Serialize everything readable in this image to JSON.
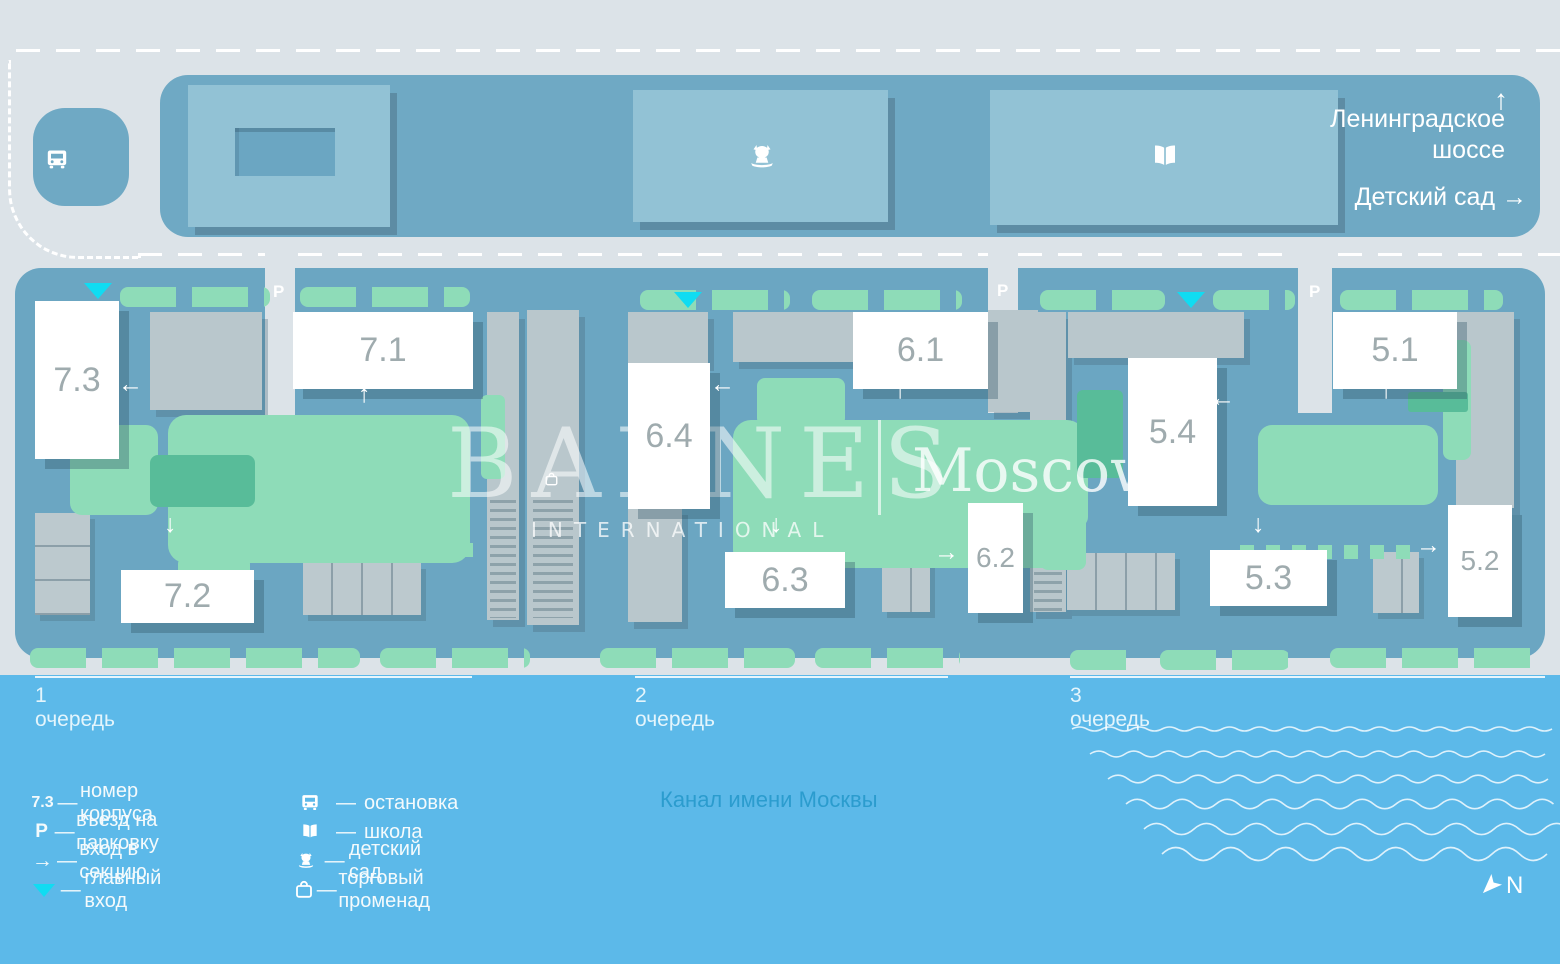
{
  "brand": {
    "name": "BARNES",
    "division": "INTERNATIONAL",
    "city": "Moscow"
  },
  "top_area": {
    "highway_arrow": "↑",
    "highway_line1": "Ленинградское",
    "highway_line2": "шоссе",
    "kindergarten_label": "Детский сад",
    "kindergarten_arrow": "→"
  },
  "water": {
    "canal_label": "Канал имени Москвы"
  },
  "compass": {
    "label": "N"
  },
  "phases": [
    {
      "label": "1 очередь",
      "x": 35,
      "line_width": 437
    },
    {
      "label": "2 очередь",
      "x": 635,
      "line_width": 313
    },
    {
      "label": "3 очередь",
      "x": 1070,
      "line_width": 475
    }
  ],
  "buildings": [
    {
      "id": "7.3",
      "x": 35,
      "y": 301,
      "w": 84,
      "h": 158
    },
    {
      "id": "7.1",
      "x": 293,
      "y": 312,
      "w": 180,
      "h": 77
    },
    {
      "id": "7.2",
      "x": 121,
      "y": 570,
      "w": 133,
      "h": 53
    },
    {
      "id": "6.4",
      "x": 628,
      "y": 363,
      "w": 82,
      "h": 146
    },
    {
      "id": "6.1",
      "x": 853,
      "y": 312,
      "w": 135,
      "h": 77
    },
    {
      "id": "6.3",
      "x": 725,
      "y": 552,
      "w": 120,
      "h": 56
    },
    {
      "id": "6.2",
      "x": 968,
      "y": 503,
      "w": 55,
      "h": 110
    },
    {
      "id": "5.4",
      "x": 1128,
      "y": 358,
      "w": 89,
      "h": 148
    },
    {
      "id": "5.1",
      "x": 1333,
      "y": 312,
      "w": 124,
      "h": 77
    },
    {
      "id": "5.3",
      "x": 1210,
      "y": 550,
      "w": 117,
      "h": 56
    },
    {
      "id": "5.2",
      "x": 1448,
      "y": 505,
      "w": 64,
      "h": 112
    }
  ],
  "section_entrances": [
    {
      "glyph": "←",
      "x": 126,
      "y": 384
    },
    {
      "glyph": "↑",
      "x": 366,
      "y": 394
    },
    {
      "glyph": "↓",
      "x": 172,
      "y": 524
    },
    {
      "glyph": "←",
      "x": 718,
      "y": 384
    },
    {
      "glyph": "↑",
      "x": 902,
      "y": 390
    },
    {
      "glyph": "↓",
      "x": 778,
      "y": 524
    },
    {
      "glyph": "→",
      "x": 942,
      "y": 552
    },
    {
      "glyph": "←",
      "x": 1218,
      "y": 398
    },
    {
      "glyph": "↑",
      "x": 1388,
      "y": 390
    },
    {
      "glyph": "↓",
      "x": 1260,
      "y": 524
    },
    {
      "glyph": "→",
      "x": 1424,
      "y": 545
    }
  ],
  "main_entrances": [
    {
      "x": 98,
      "y": 283
    },
    {
      "x": 688,
      "y": 292
    },
    {
      "x": 1191,
      "y": 292
    }
  ],
  "parking_symbol": "P",
  "parking_entrances": [
    {
      "x": 279,
      "y": 292
    },
    {
      "x": 1003,
      "y": 291
    },
    {
      "x": 1315,
      "y": 292
    }
  ],
  "poi": [
    {
      "icon": "bus",
      "name": "bus-stop-icon",
      "x": 57,
      "y": 160,
      "size": 24
    },
    {
      "icon": "kindergarten",
      "name": "kindergarten-icon",
      "x": 762,
      "y": 157,
      "size": 30
    },
    {
      "icon": "school",
      "name": "school-icon",
      "x": 1165,
      "y": 157,
      "size": 30
    },
    {
      "icon": "promenade",
      "name": "promenade-icon",
      "x": 551,
      "y": 479,
      "size": 15
    }
  ],
  "legend": {
    "dash": "—",
    "col1": [
      {
        "symbol": "7.3",
        "type": "text-sm",
        "label": "номер корпуса"
      },
      {
        "symbol": "P",
        "type": "text-lg",
        "label": "въезд на парковку"
      },
      {
        "symbol": "→",
        "type": "arrow",
        "label": "вход в секцию"
      },
      {
        "symbol": "",
        "type": "triangle",
        "label": "главный вход"
      }
    ],
    "col2": [
      {
        "icon": "bus",
        "label": "остановка"
      },
      {
        "icon": "school",
        "label": "школа"
      },
      {
        "icon": "kindergarten",
        "label": "детский сад"
      },
      {
        "icon": "promenade",
        "label": "торговый променад"
      }
    ]
  },
  "colors": {
    "water": "#5cb9e9",
    "site_blue": "#6ba6c2",
    "band_blue": "#6fa9c4",
    "road_gray": "#dce3e8",
    "building_light_blue": "#92c2d5",
    "green": "#8edcb8",
    "green_dark": "#58bc99",
    "gray_building": "#b9c7cc",
    "accent_cyan": "#10dcf2",
    "white": "#ffffff",
    "number_gray": "#9fabae",
    "canal_text": "#2b9cce"
  }
}
